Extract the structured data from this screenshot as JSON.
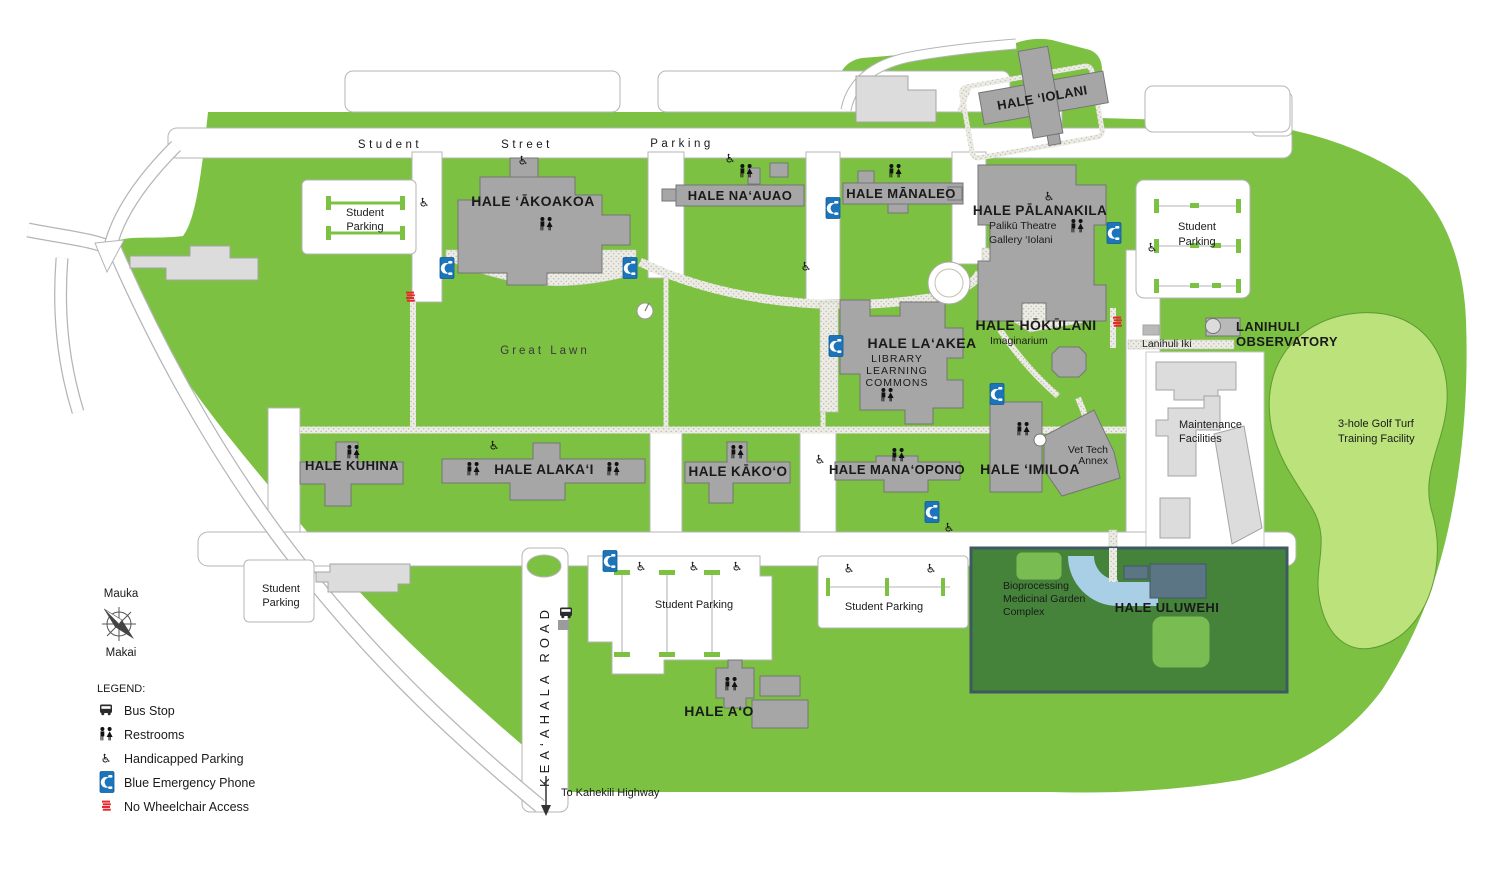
{
  "streets": {
    "w1": "Student",
    "w2": "Street",
    "w3": "Parking",
    "keaahala": "KEA‘AHALA ROAD",
    "to_highway": "To Kahekili Highway"
  },
  "areas": {
    "great_lawn": "Great Lawn",
    "golf1": "3-hole Golf Turf",
    "golf2": "Training Facility",
    "maint1": "Maintenance",
    "maint2": "Facilities",
    "garden1": "Bioprocessing",
    "garden2": "Medicinal Garden",
    "garden3": "Complex"
  },
  "parking": {
    "l1": "Student",
    "l2": "Parking",
    "single": "Student Parking"
  },
  "buildings": {
    "akoakoa": "HALE ‘ĀKOAKOA",
    "naauao": "HALE NA‘AUAO",
    "manaleo": "HALE MĀNALEO",
    "palanakila": "HALE PĀLANAKILA",
    "paliku": "Palikū Theatre",
    "gallery": "Gallery ‘Iolani",
    "iolani": "HALE ‘IOLANI",
    "hokulani": "HALE HŌKŪLANI",
    "imaginarium": "Imaginarium",
    "laakea": "HALE LA‘AKEA",
    "library": "LIBRARY",
    "learning": "LEARNING",
    "commons": "COMMONS",
    "kuhina": "HALE KUHINA",
    "alakai": "HALE ALAKA‘I",
    "kakoo": "HALE KĀKO‘O",
    "manaopono": "HALE MANA‘OPONO",
    "imiloa": "HALE ‘IMILOA",
    "vettech1": "Vet Tech",
    "vettech2": "Annex",
    "uluwehi": "HALE ULUWEHI",
    "ao": "HALE A‘O",
    "lanihuli1": "LANIHULI",
    "lanihuli2": "OBSERVATORY",
    "lanihuli_iki": "Lanihuli Iki"
  },
  "compass": {
    "mauka": "Mauka",
    "makai": "Makai"
  },
  "legend": {
    "title": "LEGEND:",
    "items": [
      {
        "label": "Bus Stop"
      },
      {
        "label": "Restrooms"
      },
      {
        "label": "Handicapped Parking"
      },
      {
        "label": "Blue Emergency Phone"
      },
      {
        "label": "No Wheelchair Access"
      }
    ]
  },
  "colors": {
    "campus_green": "#7CC142",
    "golf_green": "#BCE27B",
    "garden_green": "#45833A",
    "building_gray": "#A6A6A6",
    "light_building_gray": "#DCDCDC",
    "phone_blue": "#1C75BB",
    "uluwehi_slate": "#5C7585",
    "path_blue": "#A9CFE6",
    "alert_red": "#E8262D"
  }
}
